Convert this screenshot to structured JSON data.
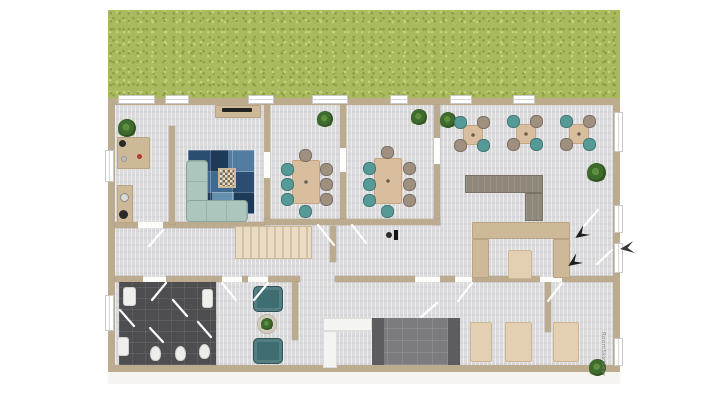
{
  "watermark": {
    "text": "RoomSketcher"
  },
  "colors": {
    "background": "#ffffff",
    "grass": "#a8b95e",
    "grass_speckle_dark": "#8aa03f",
    "grass_speckle_light": "#c6d17e",
    "wall": "#bcab8f",
    "floor": "#dbdbdd",
    "bathroom_floor": "#4e4d4f",
    "bar_floor": "#7c7c7f",
    "bar_pillar": "#5d5d60",
    "white_fixture": "#f4f4f2",
    "window": "#ffffff",
    "window_frame": "#c8c8c6",
    "wood": "#d8bd9e",
    "wood_border": "#c3a67f",
    "wood_light": "#e4cfb3",
    "counter": "#cdb898",
    "stair": "#e9dbc4",
    "stair_tread": "#d3c1a4",
    "sofa": "#adc6bd",
    "sofa_border": "#87a79b",
    "armchair": "#3e6d72",
    "armchair_border": "#2d5358",
    "chair_teal": "#569a97",
    "chair_taupe": "#9f8f7f",
    "bench_gray": "#8f8779",
    "rug_1": "#2c4d72",
    "rug_2": "#527ba1",
    "rug_3": "#1d3a59",
    "rug_4": "#7ba3c0",
    "rug_5": "#3f6a92",
    "rug_6": "#6590ad",
    "plant_dark": "#3f6b2f",
    "plant_light": "#5e8f3e",
    "arrow": "#1e1e1e",
    "watermark_color": "#8a8a85"
  },
  "furniture_manifest": {
    "lounge": [
      "kitchen-counter",
      "sink",
      "stove",
      "desk",
      "plant",
      "tv-sideboard",
      "corner-sofa",
      "coffee-table",
      "patchwork-rug"
    ],
    "meeting_room_1": {
      "conference_tables": 1,
      "chairs": 8,
      "plants": 1
    },
    "meeting_room_2": {
      "conference_tables": 1,
      "chairs": 8,
      "plants": 1
    },
    "cafe": {
      "square_tables": 3,
      "chairs_per_table": 4,
      "l_shaped_bench": 1,
      "booth_seating": 1,
      "plants": 2
    },
    "hall": [
      "staircase",
      "floor-lamp"
    ],
    "bathrooms": {
      "toilets": 3,
      "sinks": 3,
      "door_swings": 7
    },
    "reading_nook": {
      "armchairs": 2,
      "round_side_table": 1
    },
    "bar_kitchen": [
      "white-l-counter",
      "dark-tiled-floor",
      "pillars"
    ],
    "bottom_seating": {
      "tables": 3,
      "plants": 1
    },
    "entrance": {
      "direction_arrows": 3,
      "doors": 2
    }
  }
}
